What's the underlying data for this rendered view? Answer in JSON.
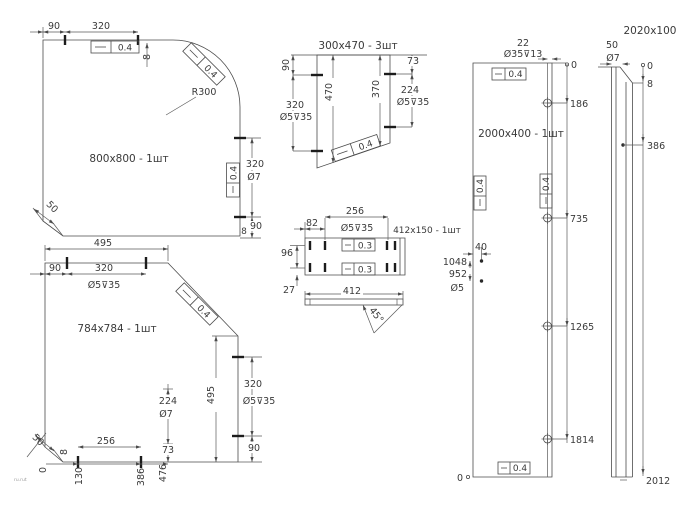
{
  "canvas": {
    "background": "#ffffff",
    "line_color": "#4b4b4b",
    "text_color": "#3a3a3a"
  },
  "parts": {
    "panel_800": {
      "title": "800x800 - 1шт",
      "dim_offset_top": "90",
      "dim_span_top": "320",
      "tol_flatness": "0.4",
      "dim_step": "8",
      "radius_label": "R300",
      "dim_span_right": "320",
      "hole_note_right": "Ø7",
      "dim_offset_right": "90",
      "dim_step_bottom": "8",
      "chamfer_dim": "50"
    },
    "panel_784": {
      "title": "784x784 - 1шт",
      "dim_width_top": "495",
      "dim_offset_top": "90",
      "dim_span_top": "320",
      "hole_note_top": "Ø5⊽35",
      "tol_flatness": "0.4",
      "dim_height_right": "495",
      "dim_span_right": "320",
      "hole_note_right": "Ø5⊽35",
      "dim_offset_right": "90",
      "dim_span_inner": "224",
      "hole_note_inner": "Ø7",
      "dim_offset_inner": "73",
      "dim_span_bottom": "256",
      "ordinate_130": "130",
      "ordinate_386": "386",
      "ordinate_476": "476",
      "chamfer_dim": "50",
      "dim_step": "8",
      "ordinate_zero": "0"
    },
    "panel_300": {
      "title": "300x470 - 3шт",
      "dim_offset_top": "90",
      "dim_span_left": "320",
      "hole_note_left": "Ø5⊽35",
      "dim_height_mid": "470",
      "dim_height_right": "370",
      "dim_offset_right": "73",
      "dim_span_right": "224",
      "hole_note_right": "Ø5⊽35",
      "tol_flatness": "0.4"
    },
    "panel_412": {
      "title": "412x150 - 1шт",
      "dim_span_top": "256",
      "dim_offset_top": "82",
      "hole_note_top": "Ø5⊽35",
      "dim_height_left": "96",
      "dim_offset_left": "27",
      "tol_flatness": "0.3",
      "dim_length_side": "412",
      "chamfer_angle": "45°"
    },
    "panel_2000": {
      "title": "2000x400 - 1шт",
      "dim_offset_top": "22",
      "hole_note_top": "Ø35⊽13",
      "tol_flatness": "0.4",
      "dim_offset_left": "40",
      "ordinate_1048": "1048",
      "ordinate_952": "952",
      "hole_note_left": "Ø5",
      "ordinate_zero_top": "0",
      "ordinate_186": "186",
      "ordinate_735": "735",
      "ordinate_1265": "1265",
      "ordinate_1814": "1814",
      "ordinate_zero_bottom": "0"
    },
    "strip_2020": {
      "title": "2020x100",
      "dim_offset_top": "50",
      "hole_note": "Ø7",
      "ordinate_zero": "0",
      "ordinate_8": "8",
      "ordinate_386": "386",
      "ordinate_2012": "2012"
    }
  },
  "stamp": "ru.rut"
}
